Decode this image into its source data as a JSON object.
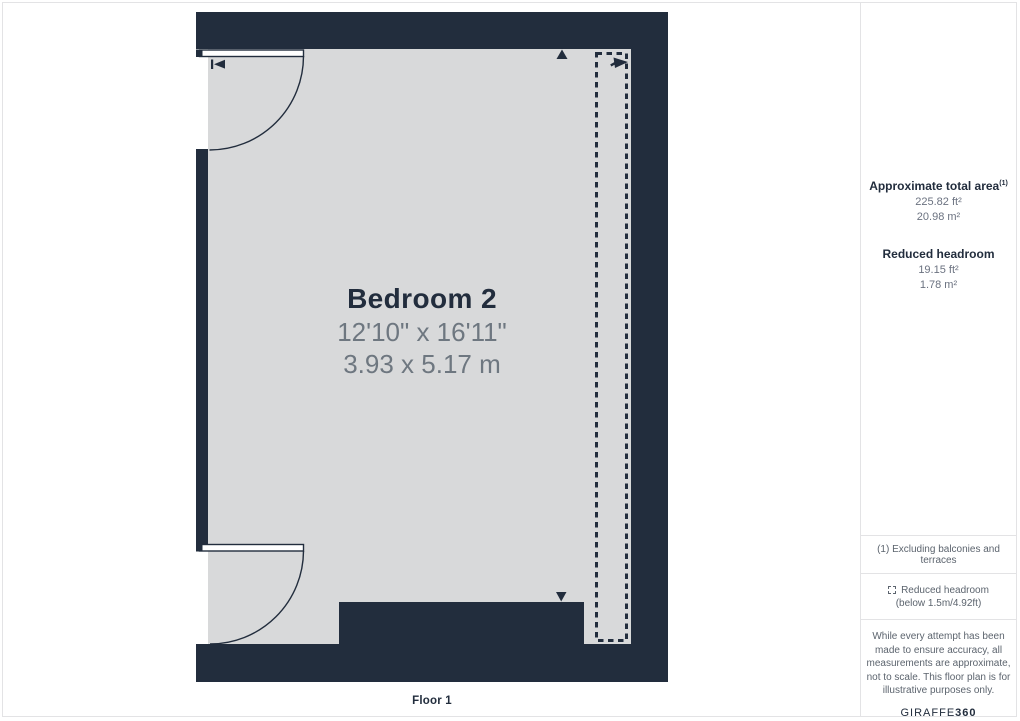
{
  "colors": {
    "navy": "#222D3D",
    "room_fill": "#D8D9DA",
    "dim_text": "#6E7780",
    "muted_text": "#6B7280",
    "divider": "#E3E3E5",
    "background": "#FFFFFF"
  },
  "floor_plan": {
    "room": {
      "name": "Bedroom 2",
      "dimensions_imperial": "12'10\" x 16'11\"",
      "dimensions_metric": "3.93 x 5.17 m"
    },
    "floor_label": "Floor 1",
    "icons": {
      "entrance_arrow": "|◄",
      "direction_up": "▲",
      "direction_down": "▼",
      "headroom_arrow": "➤",
      "reduced_headroom_legend": "dashed-square"
    }
  },
  "sidebar": {
    "total_area": {
      "label": "Approximate total area",
      "footnote_marker": "(1)",
      "value_imperial": "225.82 ft²",
      "value_metric": "20.98 m²"
    },
    "reduced_headroom": {
      "label": "Reduced headroom",
      "value_imperial": "19.15 ft²",
      "value_metric": "1.78 m²"
    },
    "footnote": "(1) Excluding balconies and terraces",
    "legend": {
      "label": "Reduced headroom",
      "sublabel": "(below 1.5m/4.92ft)"
    },
    "disclaimer": "While every attempt has been made to ensure accuracy, all measurements are approximate, not to scale. This floor plan is for illustrative purposes only.",
    "logo": {
      "brand": "GIRAFFE",
      "suffix": "360"
    }
  }
}
